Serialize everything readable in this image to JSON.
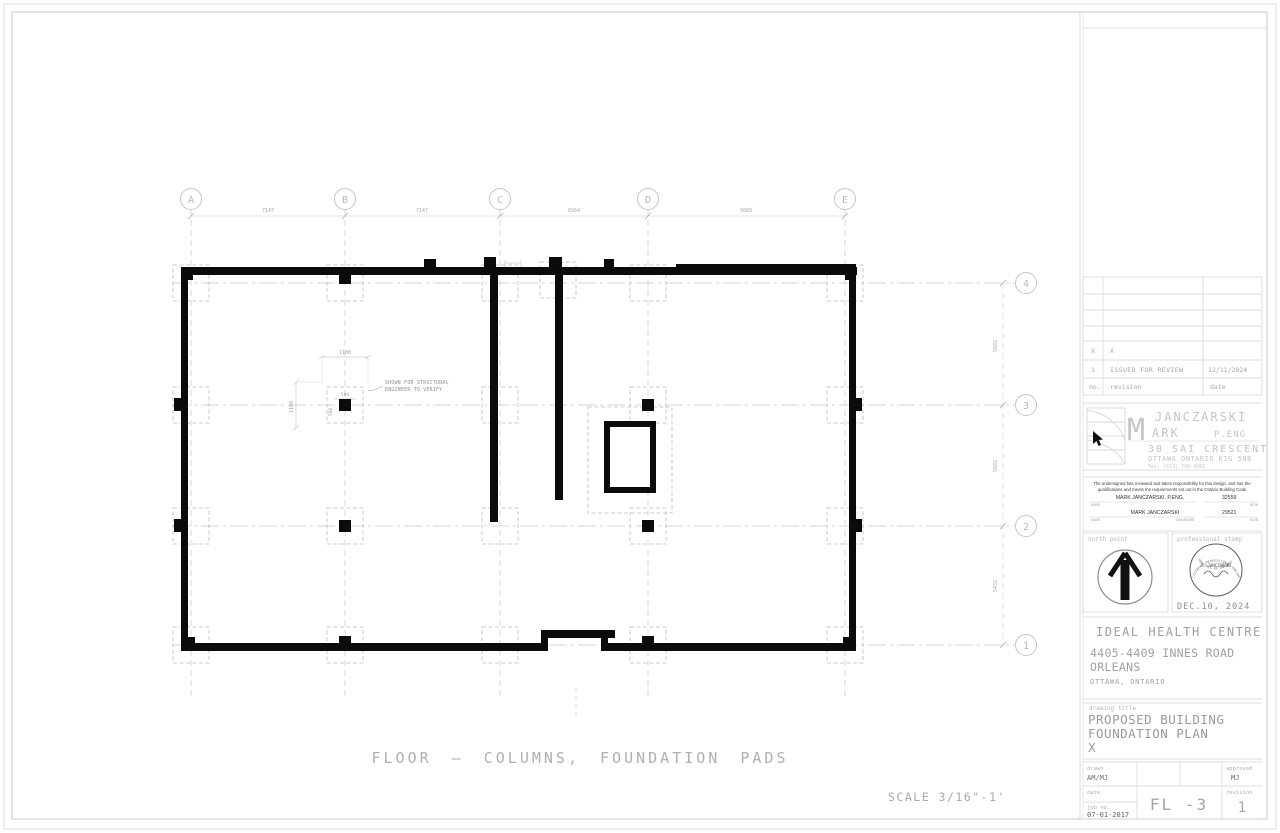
{
  "sheet": {
    "caption": "FLOOR — COLUMNS, FOUNDATION PADS",
    "scale": "SCALE 3/16\"-1'"
  },
  "plan": {
    "grid_columns": [
      "A",
      "B",
      "C",
      "D",
      "E"
    ],
    "grid_rows": [
      "4",
      "3",
      "2",
      "1"
    ],
    "dims_top": [
      "7147",
      "7147",
      "6564",
      "9089"
    ],
    "dims_right": [
      "5682",
      "5682",
      "5432"
    ],
    "pad_dims": [
      "1100",
      "1100",
      "500",
      "500"
    ],
    "note": [
      "SHOWN FOR STRUCTURAL",
      "ENGINEER TO VERIFY"
    ]
  },
  "titleblock": {
    "revision_table": {
      "rows": [
        {
          "no": "X",
          "revision": "X",
          "date": ""
        },
        {
          "no": "1",
          "revision": "ISSUED FOR REVIEW",
          "date": "12/11/2024"
        },
        {
          "no": "no.",
          "revision": "revision",
          "date": "date"
        }
      ]
    },
    "firm": {
      "m": "M",
      "name_top": "JANCZARSKI",
      "name_bottom": "ARK",
      "peng": "P.ENG",
      "address1": "30 SAI CRESCENT",
      "address2": "OTTAWA ONTARIO K1G 5N8",
      "phone": "Tel: (613) 799-4982"
    },
    "declaration": {
      "line1": "The undersigned has reviewed and takes responsibility for this design, and has the",
      "line2": "qualifications and meets the requirements set out in the Ontario Building Code",
      "name1": "MARK JANCZARSKI, P.ENG.",
      "bcin1": "32559",
      "name2": "MARK JANCZARSKI",
      "bcin2": "29521",
      "label_name": "NAME",
      "label_bcin": "BCIN",
      "label_signature": "SIGNATURE"
    },
    "north_label": "north point",
    "stamp_label": "professional stamp",
    "stamp_top": "LICENSED PROFESSIONAL ENGINEER",
    "stamp_mid": "J. JANCZARSKI",
    "stamp_bottom": "PROVINCE OF ONTARIO",
    "stamp_date": "DEC.10, 2024",
    "project": {
      "name": "IDEAL HEALTH CENTRE",
      "address1": "4405-4409 INNES ROAD",
      "address2": "ORLEANS",
      "city": "OTTAWA, ONTARIO"
    },
    "drawing": {
      "label": "drawing title",
      "line1": "PROPOSED BUILDING",
      "line2": "FOUNDATION PLAN",
      "line3": "X"
    },
    "meta": {
      "drawn_label": "drawn",
      "drawn": "AM/MJ",
      "approved_label": "approved",
      "approved": "MJ",
      "date_label": "date",
      "revision_label": "revision",
      "revision": "1",
      "jobno_label": "job no.",
      "jobno": "07-01-2017",
      "sheet_no": "FL -3"
    }
  }
}
